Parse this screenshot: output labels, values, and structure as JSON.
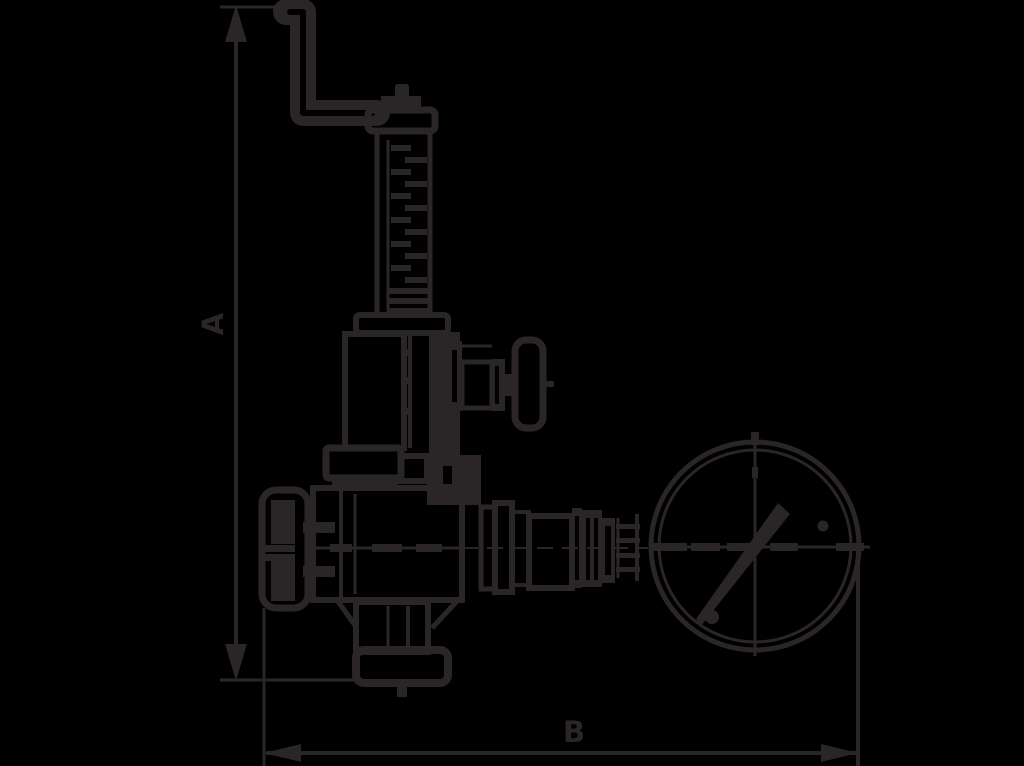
{
  "colors": {
    "background": "#000000",
    "stroke": "#2a2627"
  },
  "dimensions": {
    "vertical": {
      "label": "A"
    },
    "horizontal": {
      "label": "B"
    }
  },
  "parts": [
    "lifting-lever",
    "spring-housing",
    "spring-coils",
    "bonnet",
    "test-knob",
    "handwheel",
    "valve-body",
    "outlet-flange",
    "pipe-fittings",
    "pressure-gauge",
    "gauge-needle",
    "dimension-line-a",
    "dimension-line-b"
  ]
}
